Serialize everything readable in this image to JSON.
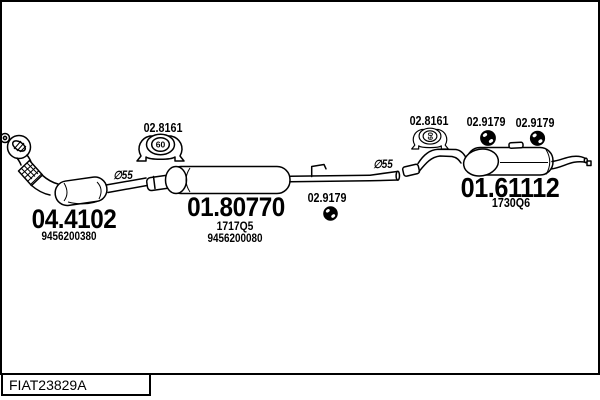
{
  "drawing": {
    "code": "FIAT23829A"
  },
  "colors": {
    "line": "#000000",
    "background": "#ffffff",
    "text": "#000000"
  },
  "parts": {
    "front_pipe": {
      "part_number": "04.4102",
      "oe_number": "9456200380"
    },
    "mid_muffler": {
      "part_number": "01.80770",
      "variant_code": "1717Q5",
      "oe_number": "9456200080"
    },
    "rear_muffler": {
      "part_number": "01.61112",
      "variant_code": "1730Q6"
    },
    "clamp_left": {
      "part_number": "02.8161",
      "diameter": "60"
    },
    "clamp_right": {
      "part_number": "02.8161",
      "diameter": "60"
    },
    "hanger_mid": {
      "part_number": "02.9179"
    },
    "hanger_rear_front": {
      "part_number": "02.9179"
    },
    "hanger_rear_back": {
      "part_number": "02.9179"
    }
  },
  "annotations": {
    "pipe_diameter_front": "∅55",
    "pipe_diameter_rear": "∅55"
  }
}
